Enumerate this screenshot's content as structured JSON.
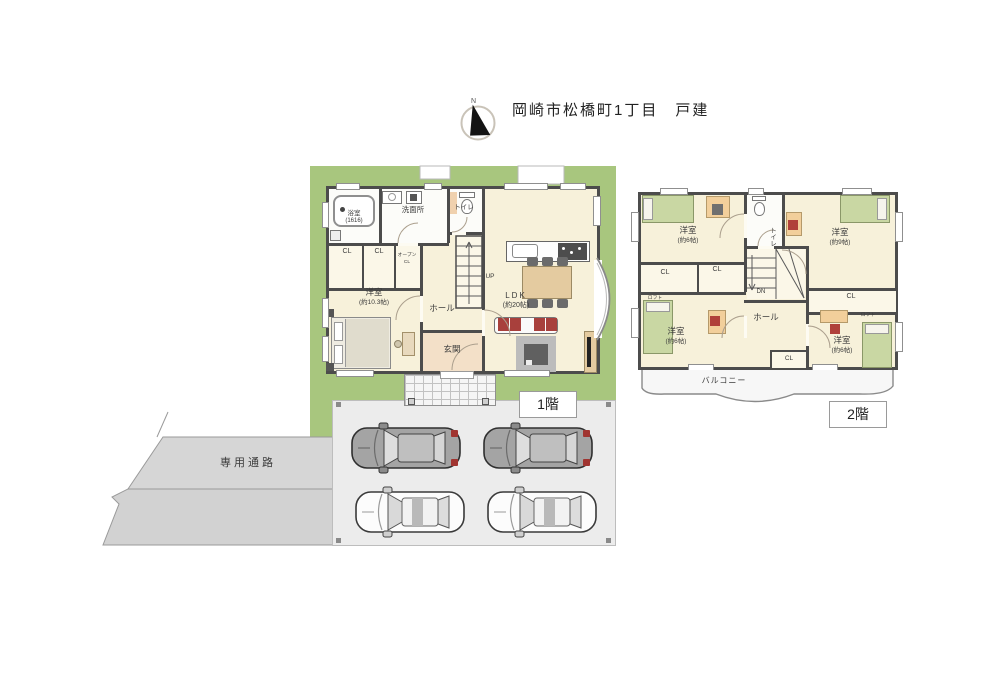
{
  "header": {
    "title": "岡崎市松橋町1丁目　戸建",
    "compass_label": "N"
  },
  "floor1": {
    "tag": "1階",
    "rooms": {
      "bath_name": "浴室",
      "bath_size": "(1616)",
      "washroom": "洗面所",
      "toilet": "トイレ",
      "closet": "CL",
      "open_closet_line1": "オープン",
      "open_closet_line2": "CL",
      "bedroom_name": "洋室",
      "bedroom_size": "(約10.3帖)",
      "hall": "ホール",
      "entrance": "玄関",
      "ldk_name": "LDK",
      "ldk_size": "(約20帖)",
      "stairs_up": "UP"
    }
  },
  "floor2": {
    "tag": "2階",
    "rooms": {
      "room_nw_name": "洋室",
      "room_nw_size": "(約6帖)",
      "room_ne_name": "洋室",
      "room_ne_size": "(約9帖)",
      "room_sw_name": "洋室",
      "room_sw_size": "(約6帖)",
      "room_se_name": "洋室",
      "room_se_size": "(約6帖)",
      "toilet": "トイレ",
      "hall": "ホール",
      "closet": "CL",
      "loft": "ロフト",
      "stairs_down": "DN",
      "balcony": "バルコニー"
    }
  },
  "site": {
    "passage": "専用通路"
  },
  "colors": {
    "yard_green": "#a8c67e",
    "room_cream": "#f7f1da",
    "wall_gray": "#4c4c4c",
    "parking_gray": "#ececec",
    "passage_gray": "#d6d6d6",
    "bed_green": "#c9d7a3",
    "desk_orange": "#f2cf9b",
    "cushion_red": "#a8403c"
  }
}
